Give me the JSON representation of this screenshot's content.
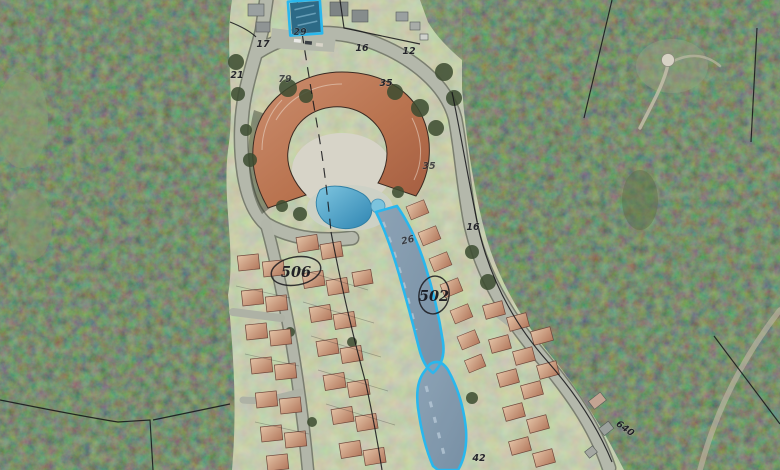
{
  "map": {
    "kind": "aerial-cadastral-map",
    "labels": {
      "l21": "21",
      "l17": "17",
      "l79": "79",
      "l29": "29",
      "l16a": "16",
      "l12": "12",
      "l35a": "35",
      "l35b": "35",
      "l16b": "16",
      "l26": "26",
      "l506": "506",
      "l502": "502",
      "l42": "42",
      "l640": "640"
    },
    "highlighted_parcel_labels": [
      "502"
    ],
    "colors": {
      "highlight_cyan": "#29b7ed",
      "forest_green": "#31402a",
      "grass_olive": "#909c78",
      "road_gray": "#b4b8ab",
      "hotel_roof": "#c07f61",
      "house_roof": "#cfa586",
      "pool_blue": "#4fa6cc",
      "boundary_black": "#131316"
    }
  }
}
